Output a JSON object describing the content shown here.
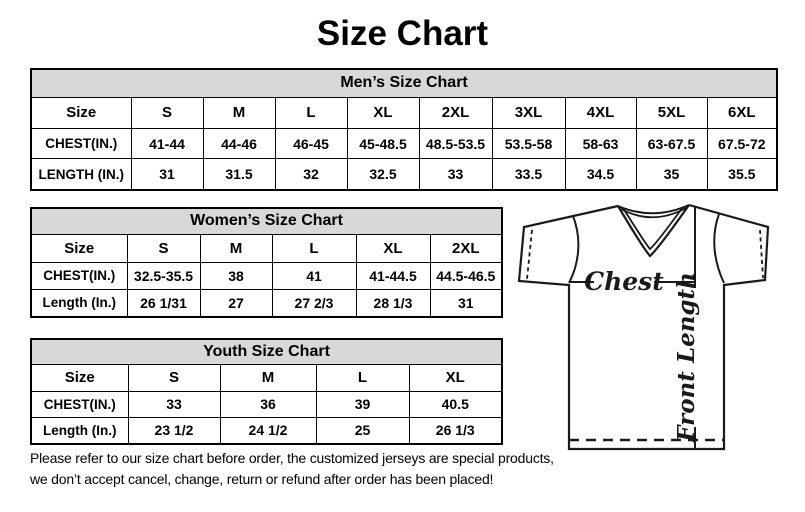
{
  "title": "Size Chart",
  "colors": {
    "page_bg": "#ffffff",
    "header_band_bg": "#d8d8d8",
    "border": "#000000",
    "text": "#000000"
  },
  "tables": {
    "men": {
      "header": "Men’s Size Chart",
      "size_label": "Size",
      "sizes": [
        "S",
        "M",
        "L",
        "XL",
        "2XL",
        "3XL",
        "4XL",
        "5XL",
        "6XL"
      ],
      "chest": {
        "label": "CHEST(IN.)",
        "values": [
          "41-44",
          "44-46",
          "46-45",
          "45-48.5",
          "48.5-53.5",
          "53.5-58",
          "58-63",
          "63-67.5",
          "67.5-72"
        ]
      },
      "length": {
        "label": "LENGTH (IN.)",
        "values": [
          "31",
          "31.5",
          "32",
          "32.5",
          "33",
          "33.5",
          "34.5",
          "35",
          "35.5"
        ]
      }
    },
    "women": {
      "header": "Women’s Size Chart",
      "size_label": "Size",
      "sizes": [
        "S",
        "M",
        "L",
        "XL",
        "2XL"
      ],
      "chest": {
        "label": "CHEST(IN.)",
        "values": [
          "32.5-35.5",
          "38",
          "41",
          "41-44.5",
          "44.5-46.5"
        ]
      },
      "length": {
        "label": "Length (In.)",
        "values": [
          "26 1/31",
          "27",
          "27 2/3",
          "28 1/3",
          "31"
        ]
      }
    },
    "youth": {
      "header": "Youth Size Chart",
      "size_label": "Size",
      "sizes": [
        "S",
        "M",
        "L",
        "XL"
      ],
      "chest": {
        "label": "CHEST(IN.)",
        "values": [
          "33",
          "36",
          "39",
          "40.5"
        ]
      },
      "length": {
        "label": "Length (In.)",
        "values": [
          "23 1/2",
          "24 1/2",
          "25",
          "26 1/3"
        ]
      }
    }
  },
  "diagram": {
    "chest_label": "Chest",
    "front_length_label": "Front Length"
  },
  "footer": {
    "line1": "Please refer to our size chart before order, the customized jerseys are special products,",
    "line2": "we don’t accept cancel, change, return or refund after order has been placed!"
  }
}
